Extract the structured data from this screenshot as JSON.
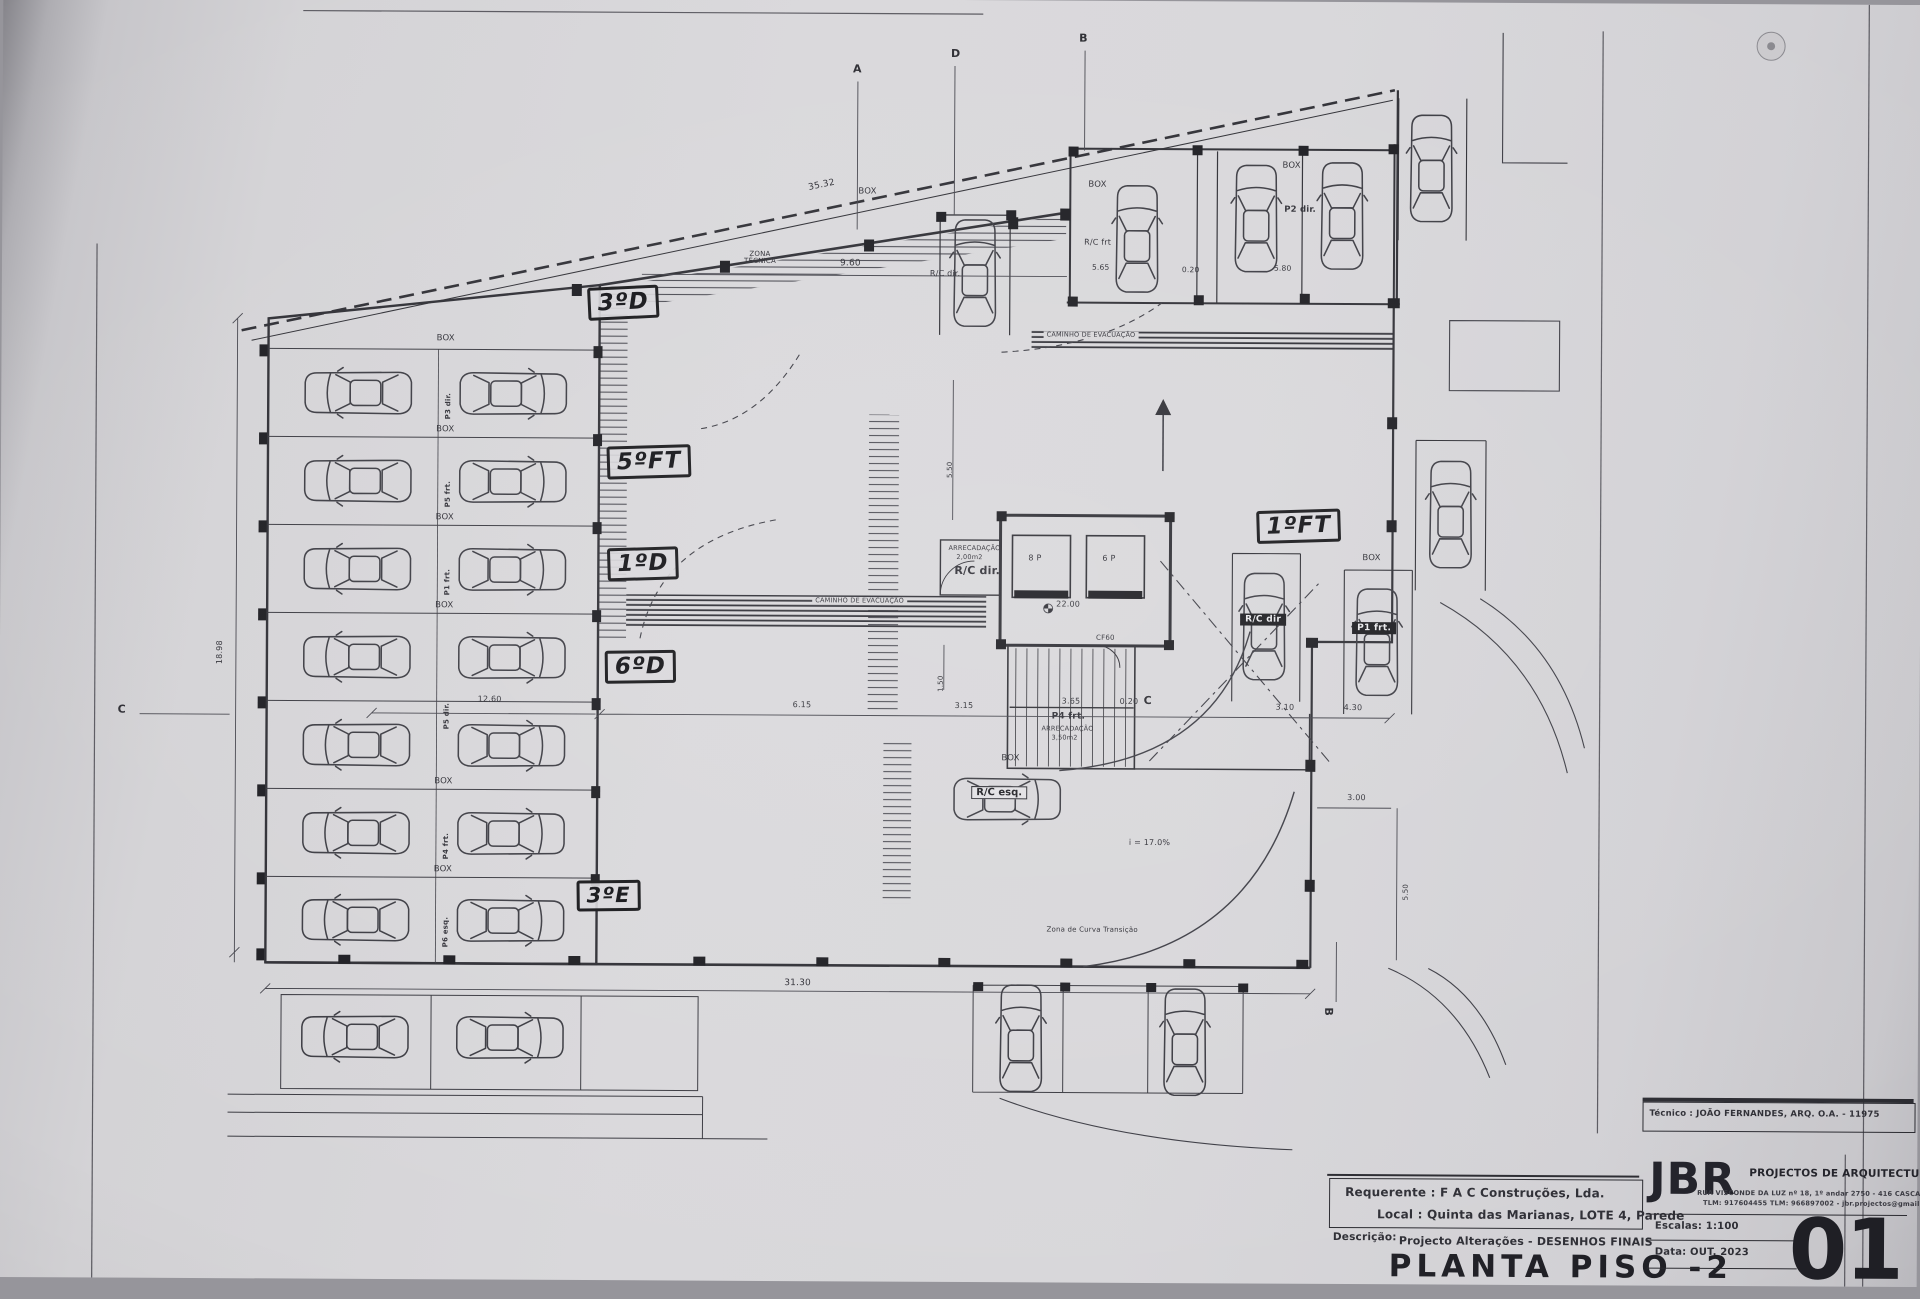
{
  "colors": {
    "paper": "#d8d7da",
    "ink": "#34343b"
  },
  "plan": {
    "box_label": "BOX",
    "zona_tecnica_line1": "ZONA",
    "zona_tecnica_line2": "TÉCNICA",
    "caminho_evacuacao": "CAMINHO DE EVACUAÇÃO",
    "zona_curva": "Zona de Curva Transição",
    "slope": "i = 17.0%",
    "arrecadacao": "ARRECADAÇÃO",
    "arrecadacao_area_rc": "2,00m2",
    "arrecadacao_area_p4": "3,50m2",
    "rc_dir": "R/C dir.",
    "rc_dir_tag": "R/C dir",
    "rc_frt": "R/C frt",
    "rc_esq": "R/C esq.",
    "p2_dir": "P2 dir.",
    "p1_frt": "P1 frt.",
    "p4_frt": "P4 frt.",
    "elevator_8p": "8 P",
    "elevator_6p": "6 P",
    "fire_door": "CF60",
    "level_value": "22.00",
    "stall_row1": "P3 dir.",
    "stall_row2": "P5 frt.",
    "stall_row3": "P1 frt.",
    "stall_row4": "P5 dir.",
    "stall_row6": "P4 frt.",
    "stall_row7": "P6 esq."
  },
  "dims": {
    "top_diag": "35.32",
    "top_span": "9.60",
    "stall_565": "5.65",
    "gap_020": "0.20",
    "stall_580": "5.80",
    "left_height": "18.98",
    "left_span": "12.60",
    "mid_615": "6.15",
    "mid_315": "3.15",
    "mid_365": "3.65",
    "mid_020": "0.20",
    "mid_310": "3.10",
    "mid_430": "4.30",
    "core_150": "1.50",
    "core_550": "5.50",
    "right_300": "3.00",
    "right_550": "5.50",
    "bottom_span": "31.30"
  },
  "handwritten": {
    "unit_3d": "3ºD",
    "unit_5ft": "5ºFT",
    "unit_1d": "1ºD",
    "unit_6d": "6ºD",
    "unit_3e": "3ºE",
    "unit_1ft": "1ºFT"
  },
  "sections": {
    "a": "A",
    "b": "B",
    "c": "C",
    "d": "D"
  },
  "titleblock": {
    "tecnico": "Técnico : JOÃO FERNANDES, ARQ.   O.A. - 11975",
    "requerente_label": "Requerente :",
    "requerente": "F A C  Construções, Lda.",
    "local_label": "Local :",
    "local": "Quinta das Marianas, LOTE 4, Parede",
    "descricao_label": "Descrição:",
    "descricao": "Projecto Alterações - DESENHOS FINAIS",
    "title": "PLANTA PISO -2",
    "firm": "JBR",
    "firm_sub": "PROJECTOS DE ARQUITECTURA",
    "address_line1": "RUA VISCONDE DA LUZ nº 18, 1º andar  2750 - 416  CASCAIS",
    "address_line2": "TLM: 917604455  TLM: 966897002 - jbr.projectos@gmail.com",
    "escalas_label": "Escalas:",
    "escalas": "1:100",
    "data_label": "Data:",
    "data": "OUT.  2023",
    "sheet_number": "01"
  }
}
